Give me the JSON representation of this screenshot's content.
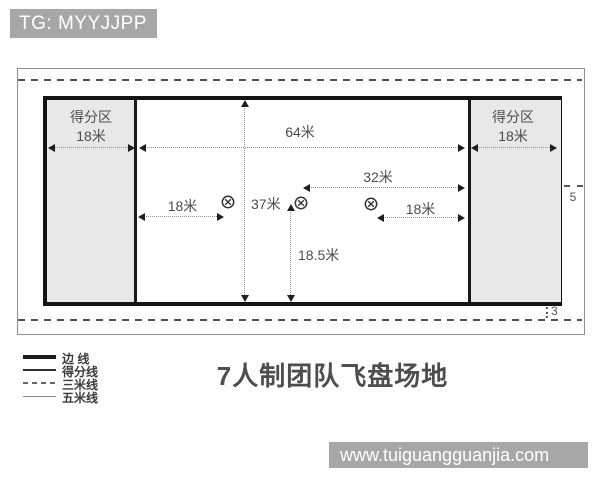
{
  "watermarks": {
    "top": "TG: MYYJJPP",
    "bottom": "www.tuiguangguanjia.com"
  },
  "title": "7人制团队飞盘场地",
  "diagram": {
    "endzone_left": {
      "label": "得分区",
      "width": "18米"
    },
    "endzone_right": {
      "label": "得分区",
      "width": "18米"
    },
    "measurements": {
      "central_length": "64米",
      "field_width": "37米",
      "half_central": "32米",
      "brick_left": "18米",
      "brick_right": "18米",
      "half_width": "18.5米",
      "five_line": "5",
      "three_line": "3"
    },
    "brick_marks": 3
  },
  "legend": {
    "items": [
      {
        "label": "边 线",
        "style": "thick"
      },
      {
        "label": "得分线",
        "style": "medium"
      },
      {
        "label": "三米线",
        "style": "dashed"
      },
      {
        "label": "五米线",
        "style": "thin"
      }
    ]
  },
  "colors": {
    "badge_bg": "#a7a7a7",
    "endzone_fill": "#e8e8e8",
    "sideline": "#141414",
    "text": "#4a4a4a"
  }
}
